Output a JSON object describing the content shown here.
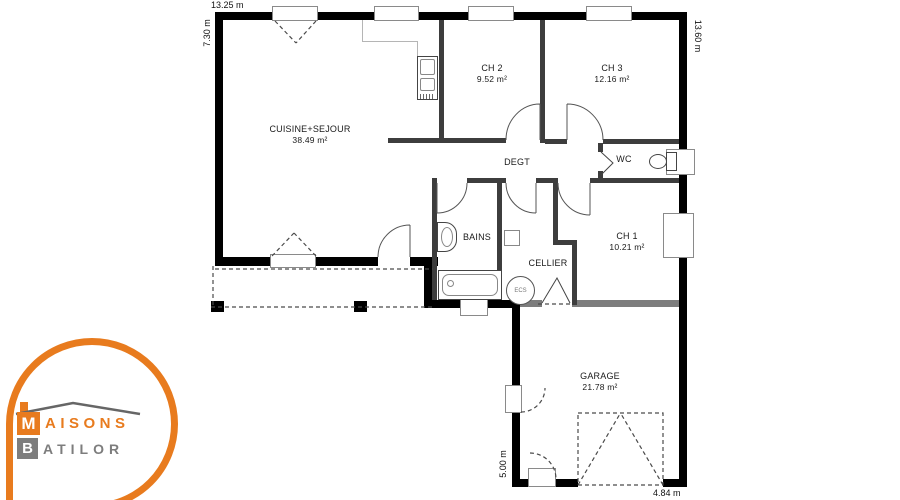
{
  "plan": {
    "dimensions": {
      "top": "13.25 m",
      "left": "7.30 m",
      "right": "13.60 m",
      "garage_left": "5.00 m",
      "garage_bottom": "4.84 m"
    },
    "rooms": {
      "living": {
        "name": "CUISINE+SEJOUR",
        "area": "38.49 m²"
      },
      "ch2": {
        "name": "CH 2",
        "area": "9.52 m²"
      },
      "ch3": {
        "name": "CH 3",
        "area": "12.16 m²"
      },
      "degt": {
        "name": "DEGT"
      },
      "wc": {
        "name": "WC"
      },
      "bains": {
        "name": "BAINS"
      },
      "cellier": {
        "name": "CELLIER"
      },
      "ch1": {
        "name": "CH 1",
        "area": "10.21 m²"
      },
      "garage": {
        "name": "GARAGE",
        "area": "21.78 m²"
      }
    },
    "fixtures": {
      "ecs_label": "ECS"
    },
    "icons": [
      "toilet-icon",
      "bathtub-icon",
      "sink-icon",
      "water-heater-icon",
      "oven-column-icon"
    ]
  },
  "logo": {
    "line1_initial": "M",
    "line1_rest": "AISONS",
    "line2_initial": "B",
    "line2_rest": "ATILOR"
  },
  "colors": {
    "outer_wall": "#000000",
    "interior_wall": "#3d3d3d",
    "garage_wall": "#7d7d7d",
    "logo_orange": "#E87B1E",
    "logo_gray": "#7D7D7D"
  }
}
